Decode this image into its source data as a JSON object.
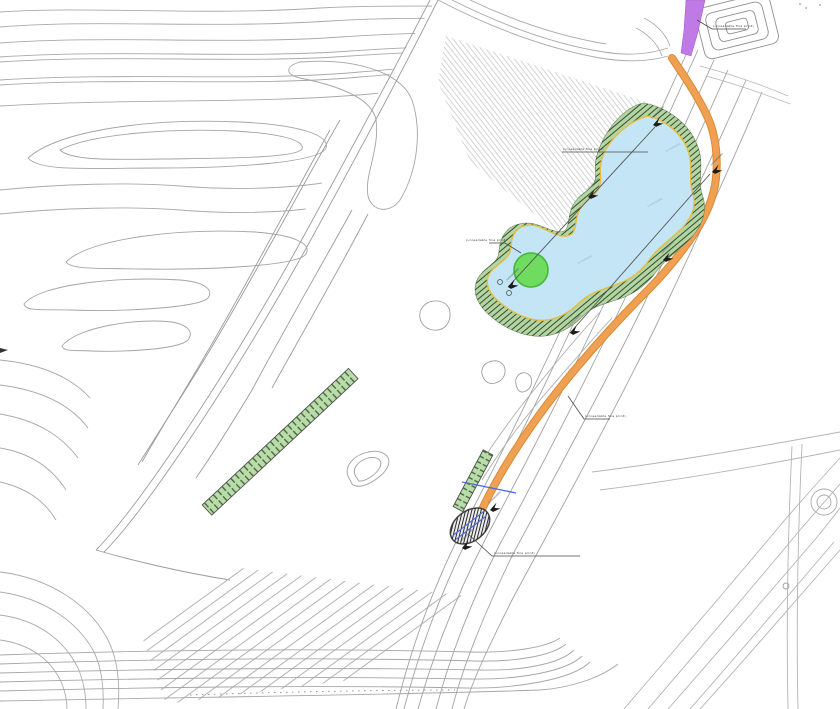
{
  "drawing": {
    "kind_label": "landscape site plan (CAD linework, no legible title block)"
  },
  "colors": {
    "background": "#ffffff",
    "linework": "#a9a9a9",
    "linework_dark": "#8f8f8f",
    "water_fill": "#c3e5f6",
    "shoreline_yellow": "#e8bc3c",
    "bank_fill": "#b5d4a4",
    "bank_hatch": "#2f4f2a",
    "strip_fill": "#badcab",
    "strip_hatch": "#3f6036",
    "tree_fill": "#6fdb5f",
    "tree_stroke": "#44b837",
    "path_orange": "#f0a053",
    "path_orange_edge": "#d98a35",
    "tram_purple": "#c07ae5",
    "pipe_blue": "#4a6fd8",
    "crossing_hatch": "#2a2a2a",
    "marker_black": "#1c1c1c",
    "leader_gray": "#4a4a4a"
  },
  "annotations": {
    "embankment_note": {
      "text": "(unreadable fine print)"
    },
    "tram_note": {
      "text": "(unreadable fine print)"
    },
    "tree_note": {
      "text": "(unreadable fine print)"
    },
    "path_note": {
      "text": "(unreadable fine print)"
    },
    "crossing_note": {
      "text": "(unreadable fine print)"
    }
  },
  "water_labels": [
    {
      "text": "(unreadable)"
    },
    {
      "text": "(unreadable)"
    },
    {
      "text": "(unreadable)"
    }
  ],
  "markers": [
    {
      "label": "(unreadable)"
    },
    {
      "label": "(unreadable)"
    },
    {
      "label": "(unreadable)"
    },
    {
      "label": "(unreadable)"
    },
    {
      "label": "(unreadable)"
    },
    {
      "label": "(unreadable)"
    },
    {
      "label": "(unreadable)"
    },
    {
      "label": "(unreadable)"
    }
  ]
}
